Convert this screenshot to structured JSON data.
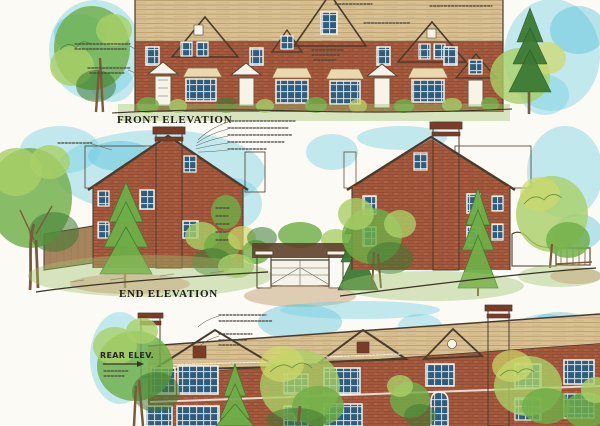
{
  "labels": {
    "front": "FRONT ELEVATION",
    "end": "END ELEVATION",
    "rear": "REAR ELEV."
  },
  "colors": {
    "paper": "#fcfaf4",
    "sky": "#6fcfe3",
    "sky-deep": "#3db8d6",
    "brick": "#a2583c",
    "brick-dark": "#7c3b28",
    "brick-light": "#c47e58",
    "roof": "#d9c194",
    "roof-line": "#a68955",
    "clap": "#d8cba6",
    "glass": "#2f5d7d",
    "trim": "#f6f3e8",
    "ink": "#3a3128",
    "foliage": "#6fae47",
    "foliage-light": "#a9cf66",
    "foliage-dark": "#3c7a33",
    "foliage-yellow": "#cfd96a",
    "trunk": "#7b5a3a",
    "grass": "#9cc46c",
    "earth": "#c5a87e",
    "fence": "#a8845c",
    "note": "#4a443c"
  }
}
